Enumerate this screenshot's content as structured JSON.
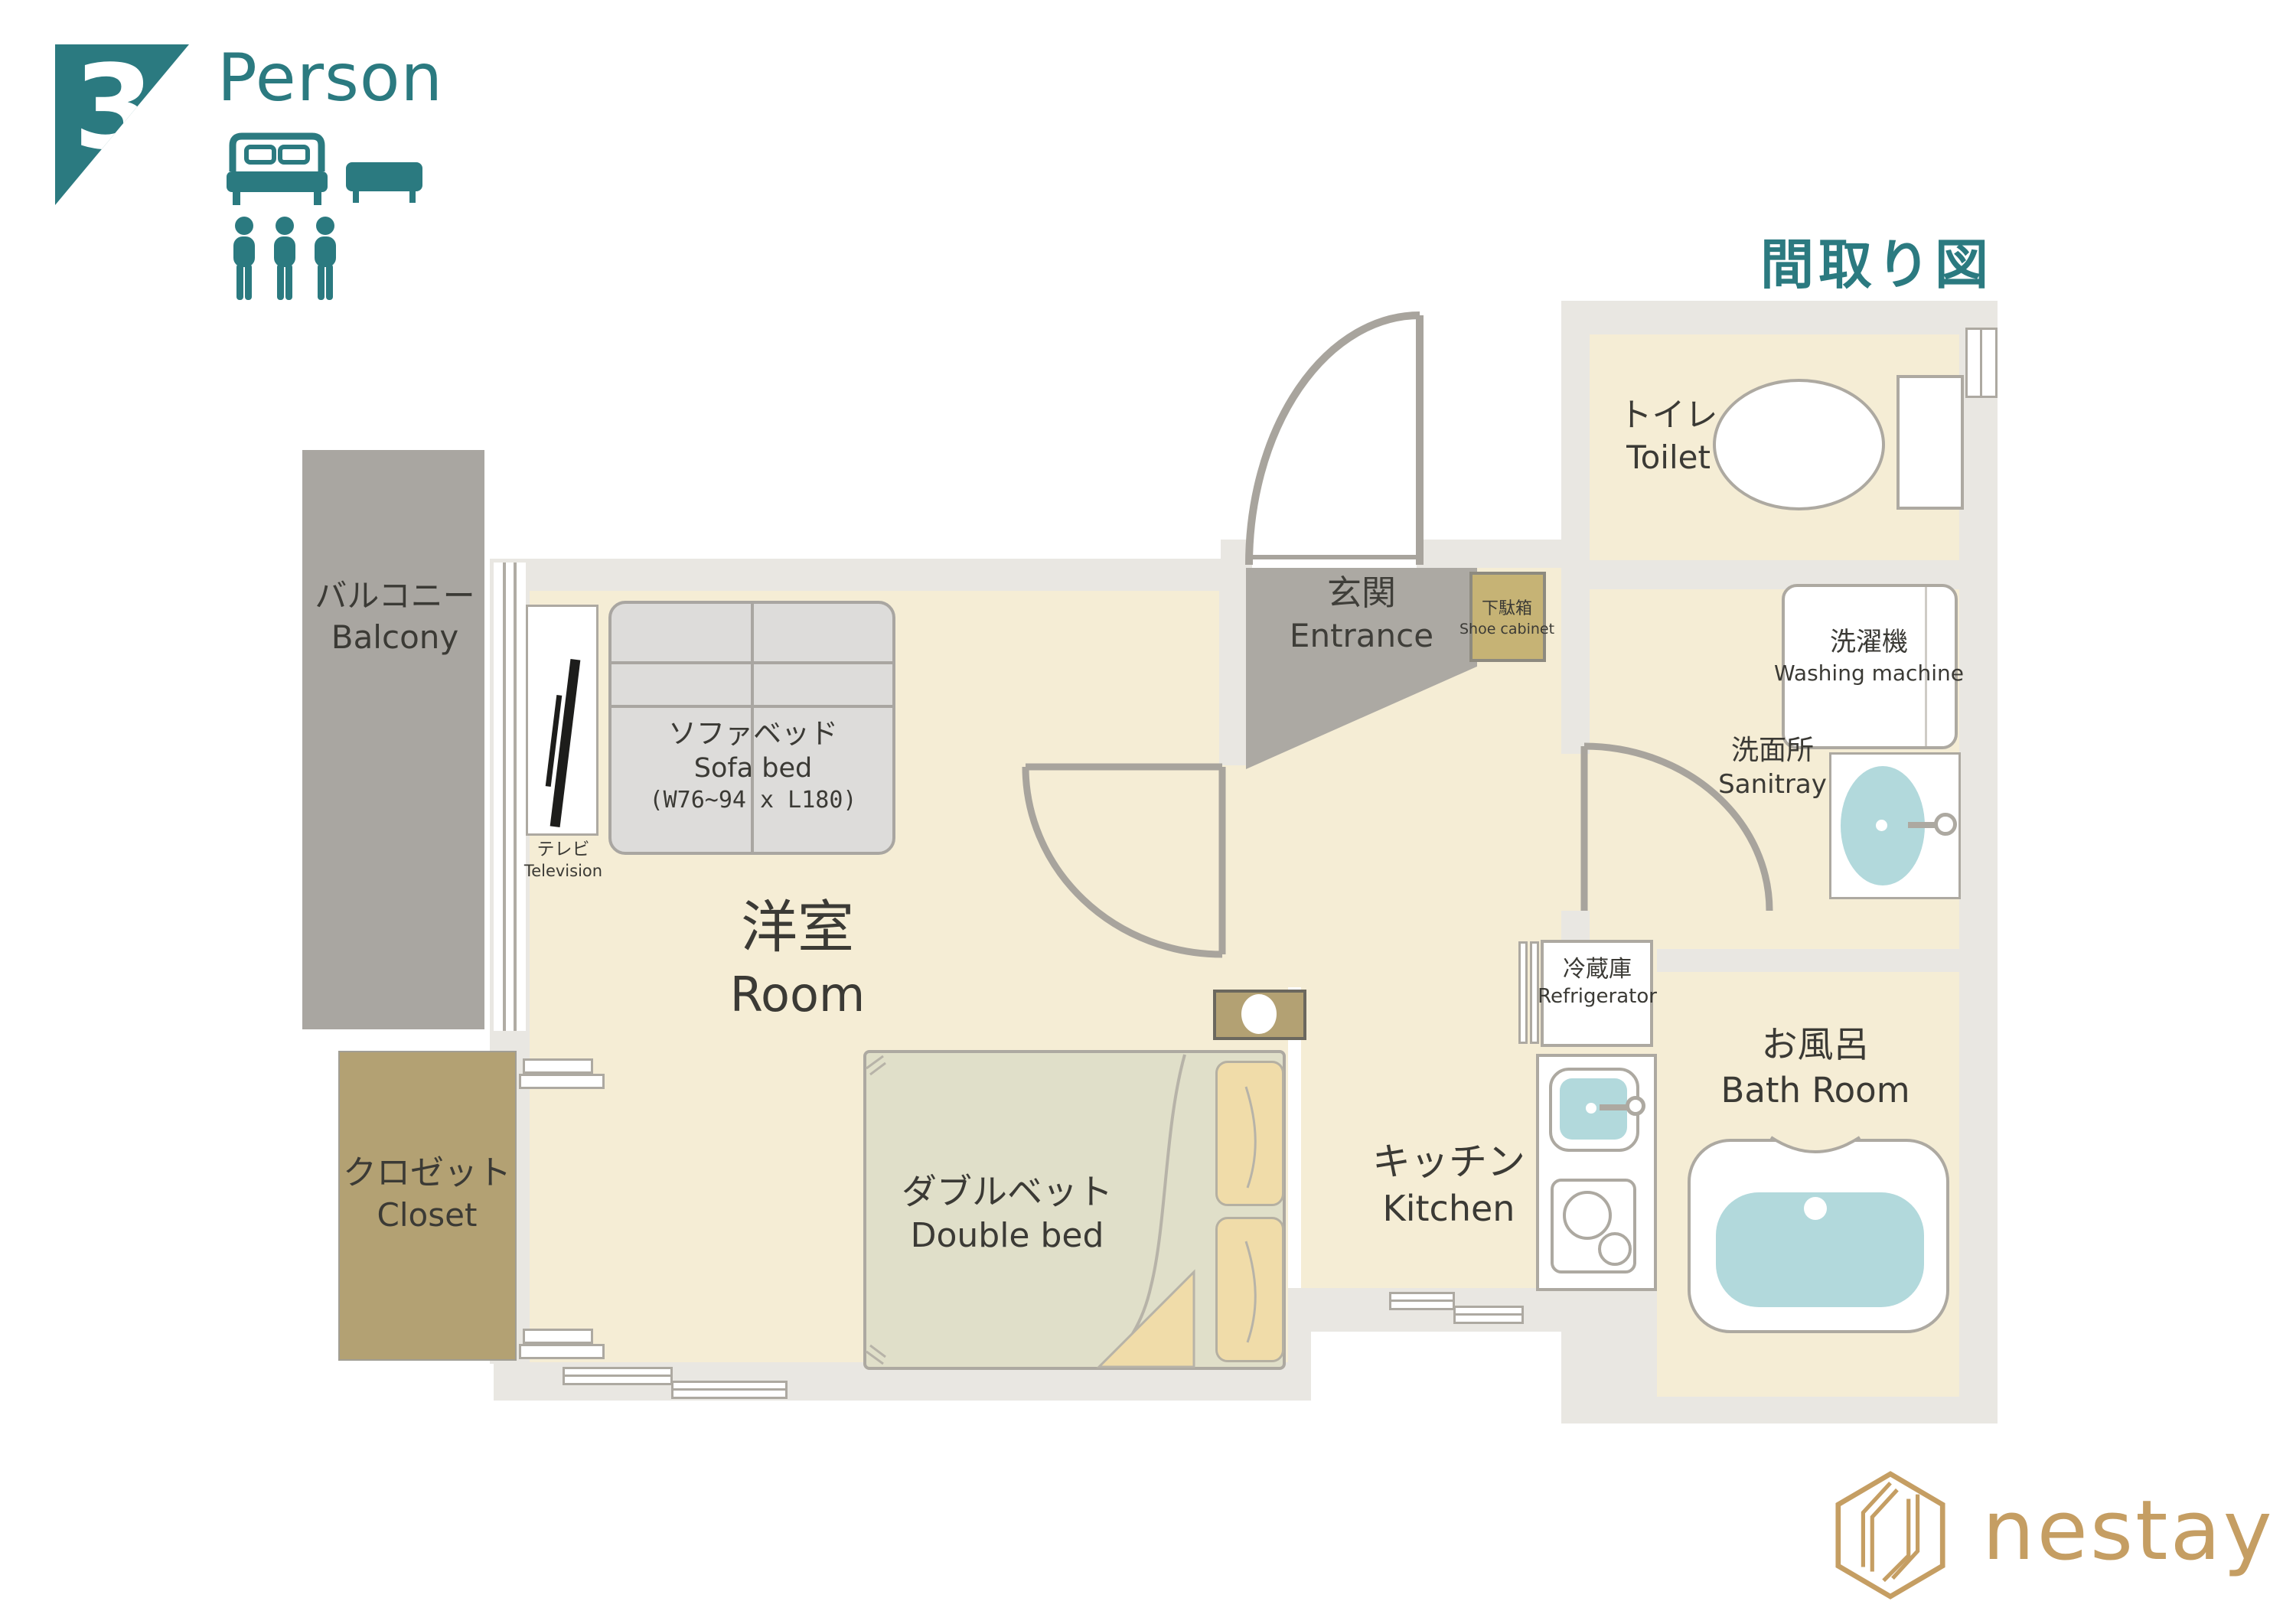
{
  "badge": {
    "count": "3",
    "label": "Person"
  },
  "title": "間取り図",
  "colors": {
    "accent_teal": "#2B7A80",
    "logo_gold": "#C59E63",
    "floor_cream": "#F5EDD5",
    "wall_gray": "#E9E7E2",
    "fixture_blue": "#B2D9DC",
    "closet_tan": "#B3A173",
    "shoe_cabinet_tan": "#C6B375",
    "balcony_gray": "#A9A6A1",
    "entrance_gray": "#ACA9A3"
  },
  "rooms": {
    "balcony": {
      "jp": "バルコニー",
      "en": "Balcony"
    },
    "room": {
      "jp": "洋室",
      "en": "Room"
    },
    "closet": {
      "jp": "クロゼット",
      "en": "Closet"
    },
    "entrance": {
      "jp": "玄関",
      "en": "Entrance"
    },
    "toilet": {
      "jp": "トイレ",
      "en": "Toilet"
    },
    "sanitray": {
      "jp": "洗面所",
      "en": "Sanitray"
    },
    "kitchen": {
      "jp": "キッチン",
      "en": "Kitchen"
    },
    "bath": {
      "jp": "お風呂",
      "en": "Bath Room"
    }
  },
  "furniture": {
    "sofa_bed": {
      "jp": "ソファベッド",
      "en": "Sofa bed",
      "dims": "(W76~94 x L180)"
    },
    "double_bed": {
      "jp": "ダブルベット",
      "en": "Double bed"
    },
    "tv": {
      "jp": "テレビ",
      "en": "Television"
    },
    "washing_machine": {
      "jp": "洗濯機",
      "en": "Washing machine"
    },
    "refrigerator": {
      "jp": "冷蔵庫",
      "en": "Refrigerator"
    },
    "shoe_cabinet": {
      "jp": "下駄箱",
      "en": "Shoe cabinet"
    }
  },
  "logo": {
    "text": "nestay"
  }
}
